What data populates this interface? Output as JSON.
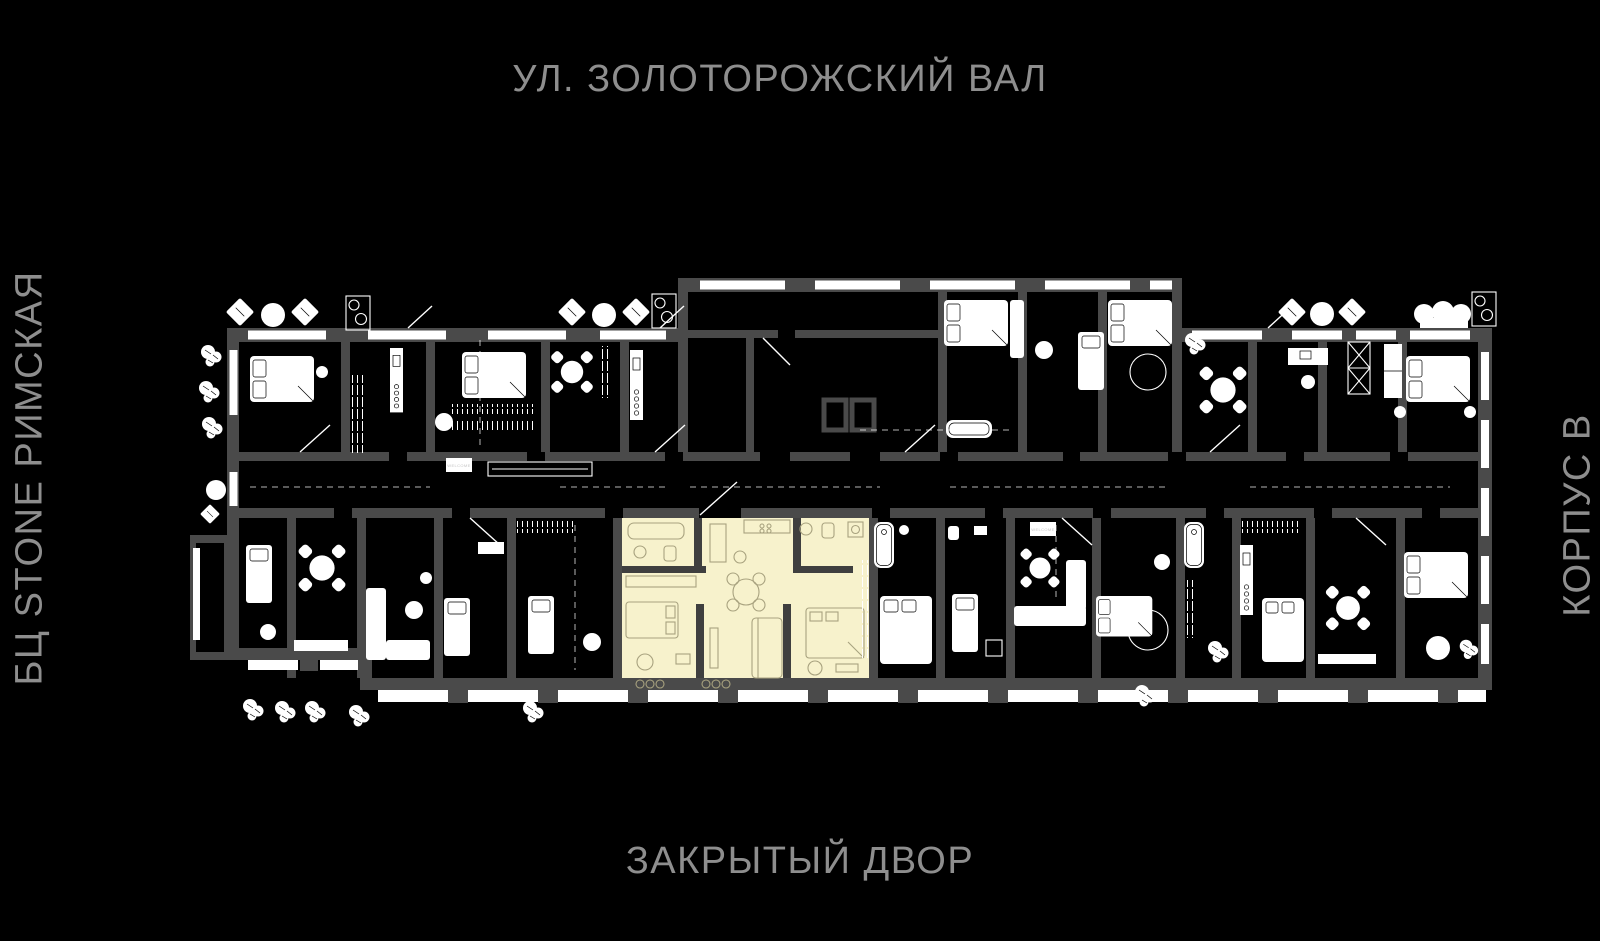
{
  "labels": {
    "street_top": "УЛ. ЗОЛОТОРОЖСКИЙ ВАЛ",
    "building_left": "БЦ STONE РИМСКАЯ",
    "building_right": "КОРПУС В",
    "courtyard_bottom": "ЗАКРЫТЫЙ ДВОР",
    "doormat": "WELCOME"
  },
  "colors": {
    "bg": "#000000",
    "wall": "#4a4a4a",
    "wall_dark": "#3f3f3f",
    "label_text": "#8e8e8e",
    "furniture": "#ffffff",
    "highlight_fill": "#f7f2cc",
    "highlight_line": "#a8a27f"
  },
  "plan": {
    "selected_apartment_highlighted": true
  }
}
